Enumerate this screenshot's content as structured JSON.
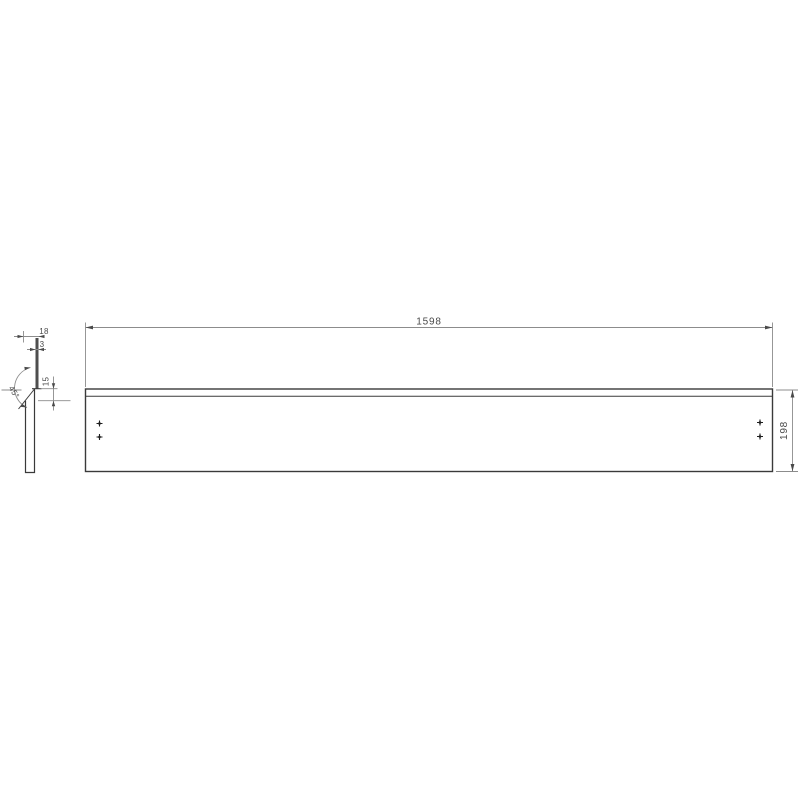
{
  "drawing": {
    "type": "technical-part-drawing",
    "views": {
      "front_view": {
        "description": "long rectangular panel, front elevation",
        "width_dim": "1598",
        "height_dim": "198",
        "hole_mark_count": 4
      },
      "side_view": {
        "description": "edge profile with 45-degree beveled top",
        "thickness_dim": "18",
        "top_edge_dim": "3",
        "bevel_height_dim": "15",
        "bevel_angle_dim": "45°"
      }
    },
    "colors": {
      "background": "#ffffff",
      "part_outline": "#3a3a3a",
      "dimension_lines": "#8c8c8c",
      "dimension_text": "#4a4a4a",
      "strip_fill": "#4e4e4e",
      "hole_marks": "#1f1f1f"
    }
  }
}
